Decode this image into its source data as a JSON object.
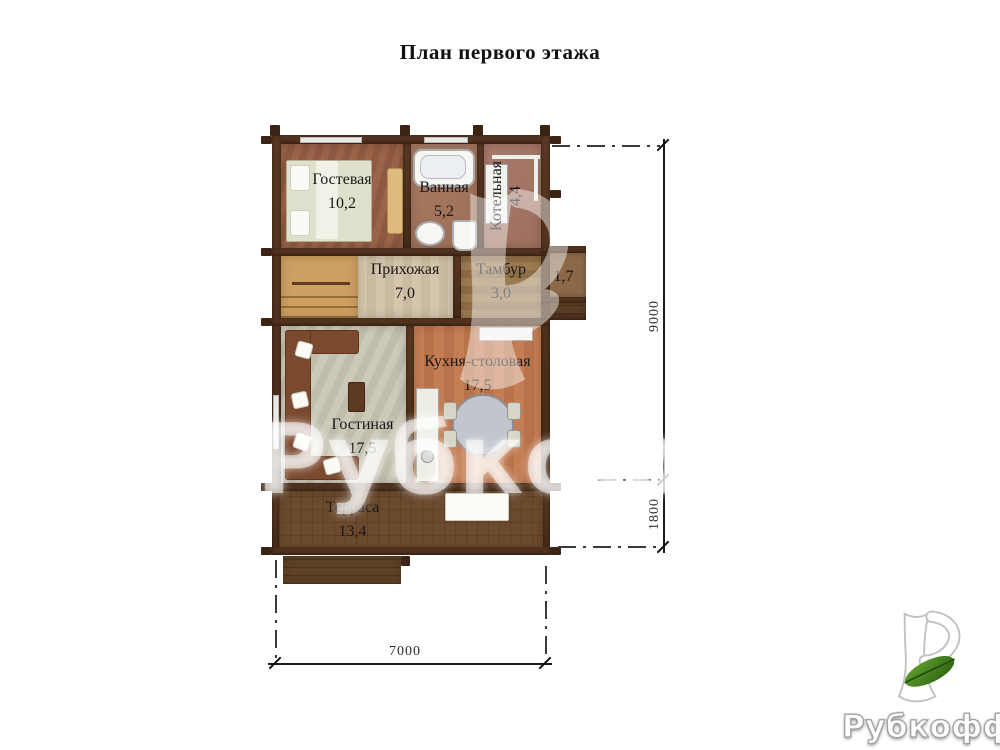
{
  "title": "План первого этажа",
  "rooms": {
    "guest": {
      "name": "Гостевая",
      "area": "10,2"
    },
    "bathroom": {
      "name": "Ванная",
      "area": "5,2"
    },
    "boiler": {
      "name": "Котельная",
      "area": "4,4"
    },
    "hallway": {
      "name": "Прихожая",
      "area": "7,0"
    },
    "vestibule": {
      "name": "Тамбур",
      "area": "3,0"
    },
    "porch": {
      "area": "1,7"
    },
    "kitchen": {
      "name": "Кухня-столовая",
      "area": "17,5"
    },
    "living": {
      "name": "Гостиная",
      "area": "17,5"
    },
    "terrace": {
      "name": "Терраса",
      "area": "13,4"
    }
  },
  "dimensions": {
    "right_main": "9000",
    "right_terrace": "1800",
    "bottom_width": "7000"
  },
  "watermark": {
    "text": "Рубкофф"
  },
  "logo": {
    "text": "Рубкофф"
  },
  "icons": {
    "logo_glyph": "stylized-r-with-leaf-icon"
  },
  "colors": {
    "wall_brown": "#4a2e1b",
    "leaf_green": "#4a8a1f",
    "terrace_brown": "#6c4a2d"
  }
}
